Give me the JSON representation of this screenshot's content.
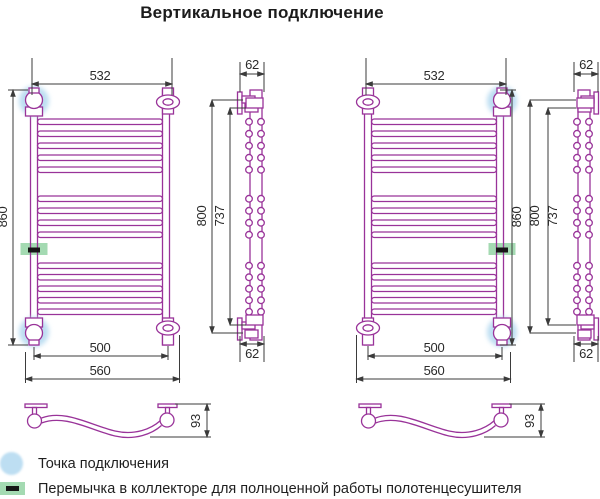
{
  "title": "Вертикальное подключение",
  "colors": {
    "pipe": "#993399",
    "dimension_lines": "#3b3b3b",
    "connection_point": "#BDDEF2",
    "jumper": "#A4DAB2",
    "jumper_dash": "#161616"
  },
  "diagrams": [
    {
      "front": {
        "top_width": "532",
        "overall_height": "860",
        "pitch_width": "500",
        "outer_width": "560"
      },
      "side": {
        "depth_top": "62",
        "height_outer": "800",
        "height_inner": "737",
        "depth_bottom": "62"
      },
      "plan": {
        "rung_depth": "93"
      }
    },
    {
      "front": {
        "top_width": "532",
        "overall_height": "860",
        "pitch_width": "500",
        "outer_width": "560"
      },
      "side": {
        "depth_top": "62",
        "height_outer": "800",
        "height_inner": "737",
        "depth_bottom": "62"
      },
      "plan": {
        "rung_depth": "93"
      }
    }
  ],
  "legend": {
    "items": [
      {
        "icon": "connection-point-icon",
        "label": "Точка подключения"
      },
      {
        "icon": "jumper-icon",
        "label": "Перемычка в коллекторе для полноценной работы полотенцесушителя"
      }
    ]
  }
}
